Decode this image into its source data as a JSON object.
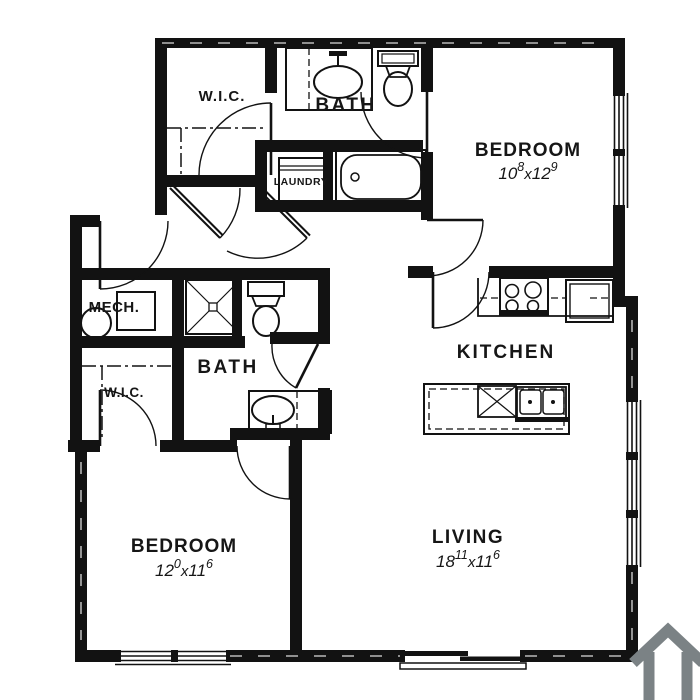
{
  "floorplan": {
    "colors": {
      "wall": "#121212",
      "background": "#ffffff",
      "logo": "#7b8285"
    },
    "dim_separator": "x",
    "rooms": [
      {
        "id": "wic-top",
        "label": "W.I.C."
      },
      {
        "id": "bath-top",
        "label": "BATH"
      },
      {
        "id": "bedroom-top",
        "label": "BEDROOM",
        "dims": {
          "w_ft": "10",
          "w_in": "8",
          "l_ft": "12",
          "l_in": "9"
        }
      },
      {
        "id": "laundry",
        "label": "LAUNDRY"
      },
      {
        "id": "mech",
        "label": "MECH."
      },
      {
        "id": "bath-mid",
        "label": "BATH"
      },
      {
        "id": "wic-left",
        "label": "W.I.C."
      },
      {
        "id": "kitchen",
        "label": "KITCHEN"
      },
      {
        "id": "bedroom-bottom",
        "label": "BEDROOM",
        "dims": {
          "w_ft": "12",
          "w_in": "0",
          "l_ft": "11",
          "l_in": "6"
        }
      },
      {
        "id": "living",
        "label": "LIVING",
        "dims": {
          "w_ft": "18",
          "w_in": "11",
          "l_ft": "11",
          "l_in": "6"
        }
      }
    ],
    "fixtures": [
      "sink",
      "toilet",
      "bathtub",
      "washer",
      "shower",
      "water-heater",
      "range",
      "refrigerator",
      "kitchen-island",
      "dishwasher",
      "double-sink"
    ]
  }
}
